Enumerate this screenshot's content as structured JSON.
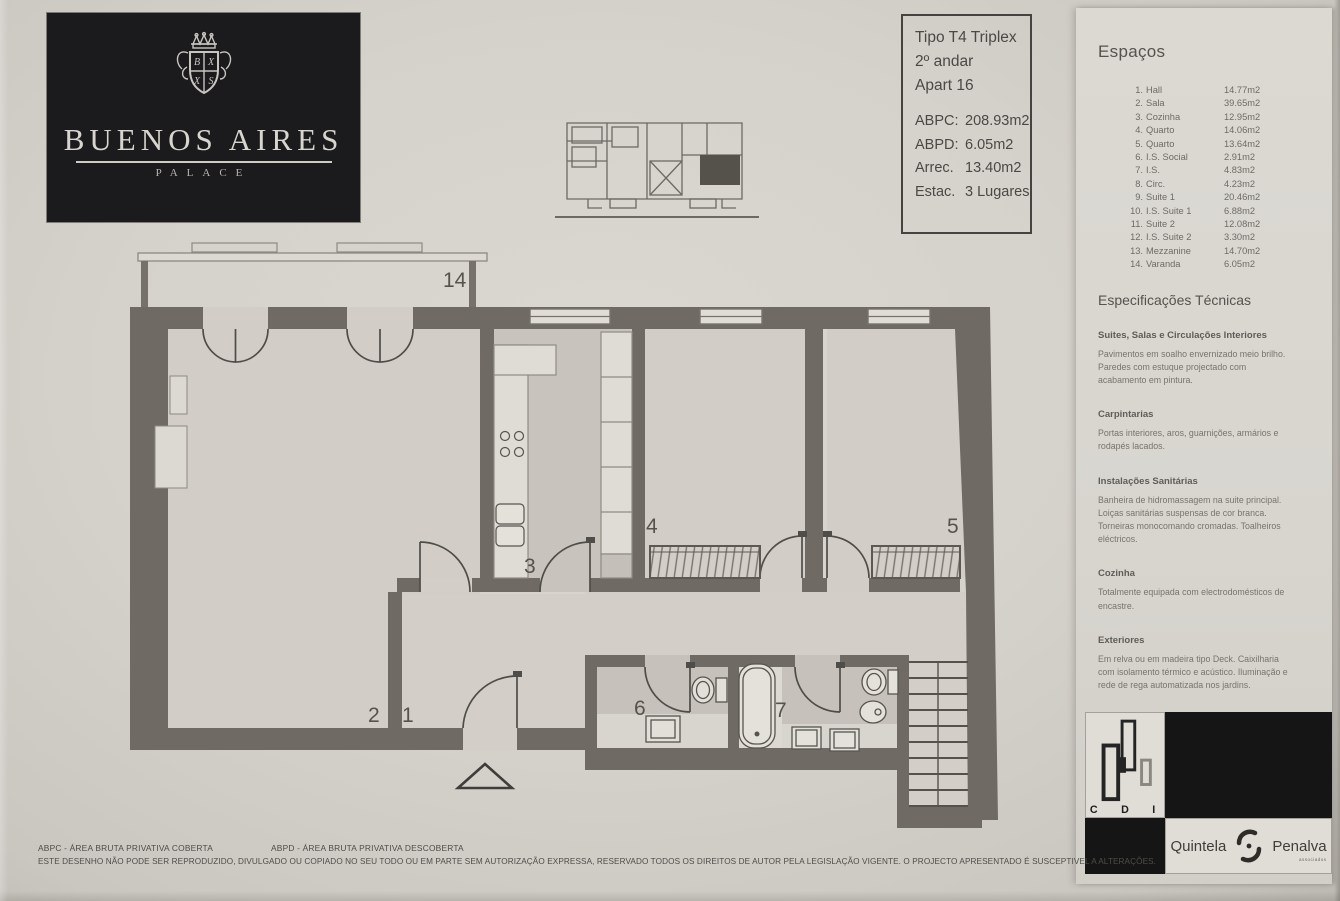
{
  "logo": {
    "title": "BUENOS AIRES",
    "subtitle": "PALACE"
  },
  "info_box": {
    "type": "Tipo T4 Triplex",
    "floor": "2º andar",
    "apartment": "Apart 16",
    "metrics": [
      {
        "label": "ABPC:",
        "value": "208.93m2"
      },
      {
        "label": "ABPD:",
        "value": "6.05m2"
      },
      {
        "label": "Arrec.",
        "value": "13.40m2"
      },
      {
        "label": "Estac.",
        "value": "3 Lugares"
      }
    ]
  },
  "spaces": {
    "title": "Espaços",
    "items": [
      {
        "num": "1.",
        "name": "Hall",
        "area": "14.77m2"
      },
      {
        "num": "2.",
        "name": "Sala",
        "area": "39.65m2"
      },
      {
        "num": "3.",
        "name": "Cozinha",
        "area": "12.95m2"
      },
      {
        "num": "4.",
        "name": "Quarto",
        "area": "14.06m2"
      },
      {
        "num": "5.",
        "name": "Quarto",
        "area": "13.64m2"
      },
      {
        "num": "6.",
        "name": "I.S. Social",
        "area": "2.91m2"
      },
      {
        "num": "7.",
        "name": "I.S.",
        "area": "4.83m2"
      },
      {
        "num": "8.",
        "name": "Circ.",
        "area": "4.23m2"
      },
      {
        "num": "9.",
        "name": "Suite 1",
        "area": "20.46m2"
      },
      {
        "num": "10.",
        "name": "I.S. Suite 1",
        "area": "6.88m2"
      },
      {
        "num": "11.",
        "name": "Suite 2",
        "area": "12.08m2"
      },
      {
        "num": "12.",
        "name": "I.S. Suite 2",
        "area": "3.30m2"
      },
      {
        "num": "13.",
        "name": "Mezzanine",
        "area": "14.70m2"
      },
      {
        "num": "14.",
        "name": "Varanda",
        "area": "6.05m2"
      }
    ]
  },
  "specs": {
    "title": "Especificações Técnicas",
    "sections": [
      {
        "heading": "Suites, Salas e Circulações Interiores",
        "body": "Pavimentos em soalho envernizado meio brilho. Paredes com estuque projectado com acabamento em pintura."
      },
      {
        "heading": "Carpintarias",
        "body": "Portas interiores, aros, guarnições, armários e rodapés lacados."
      },
      {
        "heading": "Instalações Sanitárias",
        "body": "Banheira de hidromassagem na suite principal. Loiças sanitárias suspensas de cor branca. Torneiras monocomando cromadas. Toalheiros eléctricos."
      },
      {
        "heading": "Cozinha",
        "body": "Totalmente equipada com electrodomésticos de encastre."
      },
      {
        "heading": "Exteriores",
        "body": "Em relva ou em madeira tipo Deck. Caixilharia com isolamento térmico e acústico. Iluminação e rede de rega automatizada nos jardins."
      },
      {
        "heading": "Equipamentos",
        "body": "Sistema Integrado Segurança, Domótica e Video porteiro. Sistema de climatização através bomba calor com grelhas de distribuição nas paredes e tectos."
      }
    ]
  },
  "plan": {
    "room_labels": [
      {
        "label": "14",
        "x": 443,
        "y": 287
      },
      {
        "label": "2",
        "x": 368,
        "y": 722
      },
      {
        "label": "1",
        "x": 402,
        "y": 722
      },
      {
        "label": "3",
        "x": 524,
        "y": 573
      },
      {
        "label": "4",
        "x": 646,
        "y": 533
      },
      {
        "label": "5",
        "x": 947,
        "y": 533
      },
      {
        "label": "6",
        "x": 634,
        "y": 715
      },
      {
        "label": "7",
        "x": 775,
        "y": 717
      }
    ]
  },
  "footer": {
    "abbr_left": "ABPC - ÁREA BRUTA PRIVATIVA COBERTA",
    "abbr_right": "ABPD - ÁREA BRUTA PRIVATIVA DESCOBERTA",
    "disclaimer": "ESTE DESENHO NÃO PODE SER REPRODUZIDO, DIVULGADO OU COPIADO NO SEU TODO OU EM PARTE SEM AUTORIZAÇÃO EXPRESSA, RESERVADO TODOS OS DIREITOS DE AUTOR PELA LEGISLAÇÃO VIGENTE.  O PROJECTO APRESENTADO É SUSCEPTIVEL A ALTERAÇÕES."
  },
  "brands": {
    "cdi_letters": [
      "C",
      "D",
      "I"
    ],
    "quintela": "Quintela",
    "penalva": "Penalva",
    "sub": "associados"
  }
}
